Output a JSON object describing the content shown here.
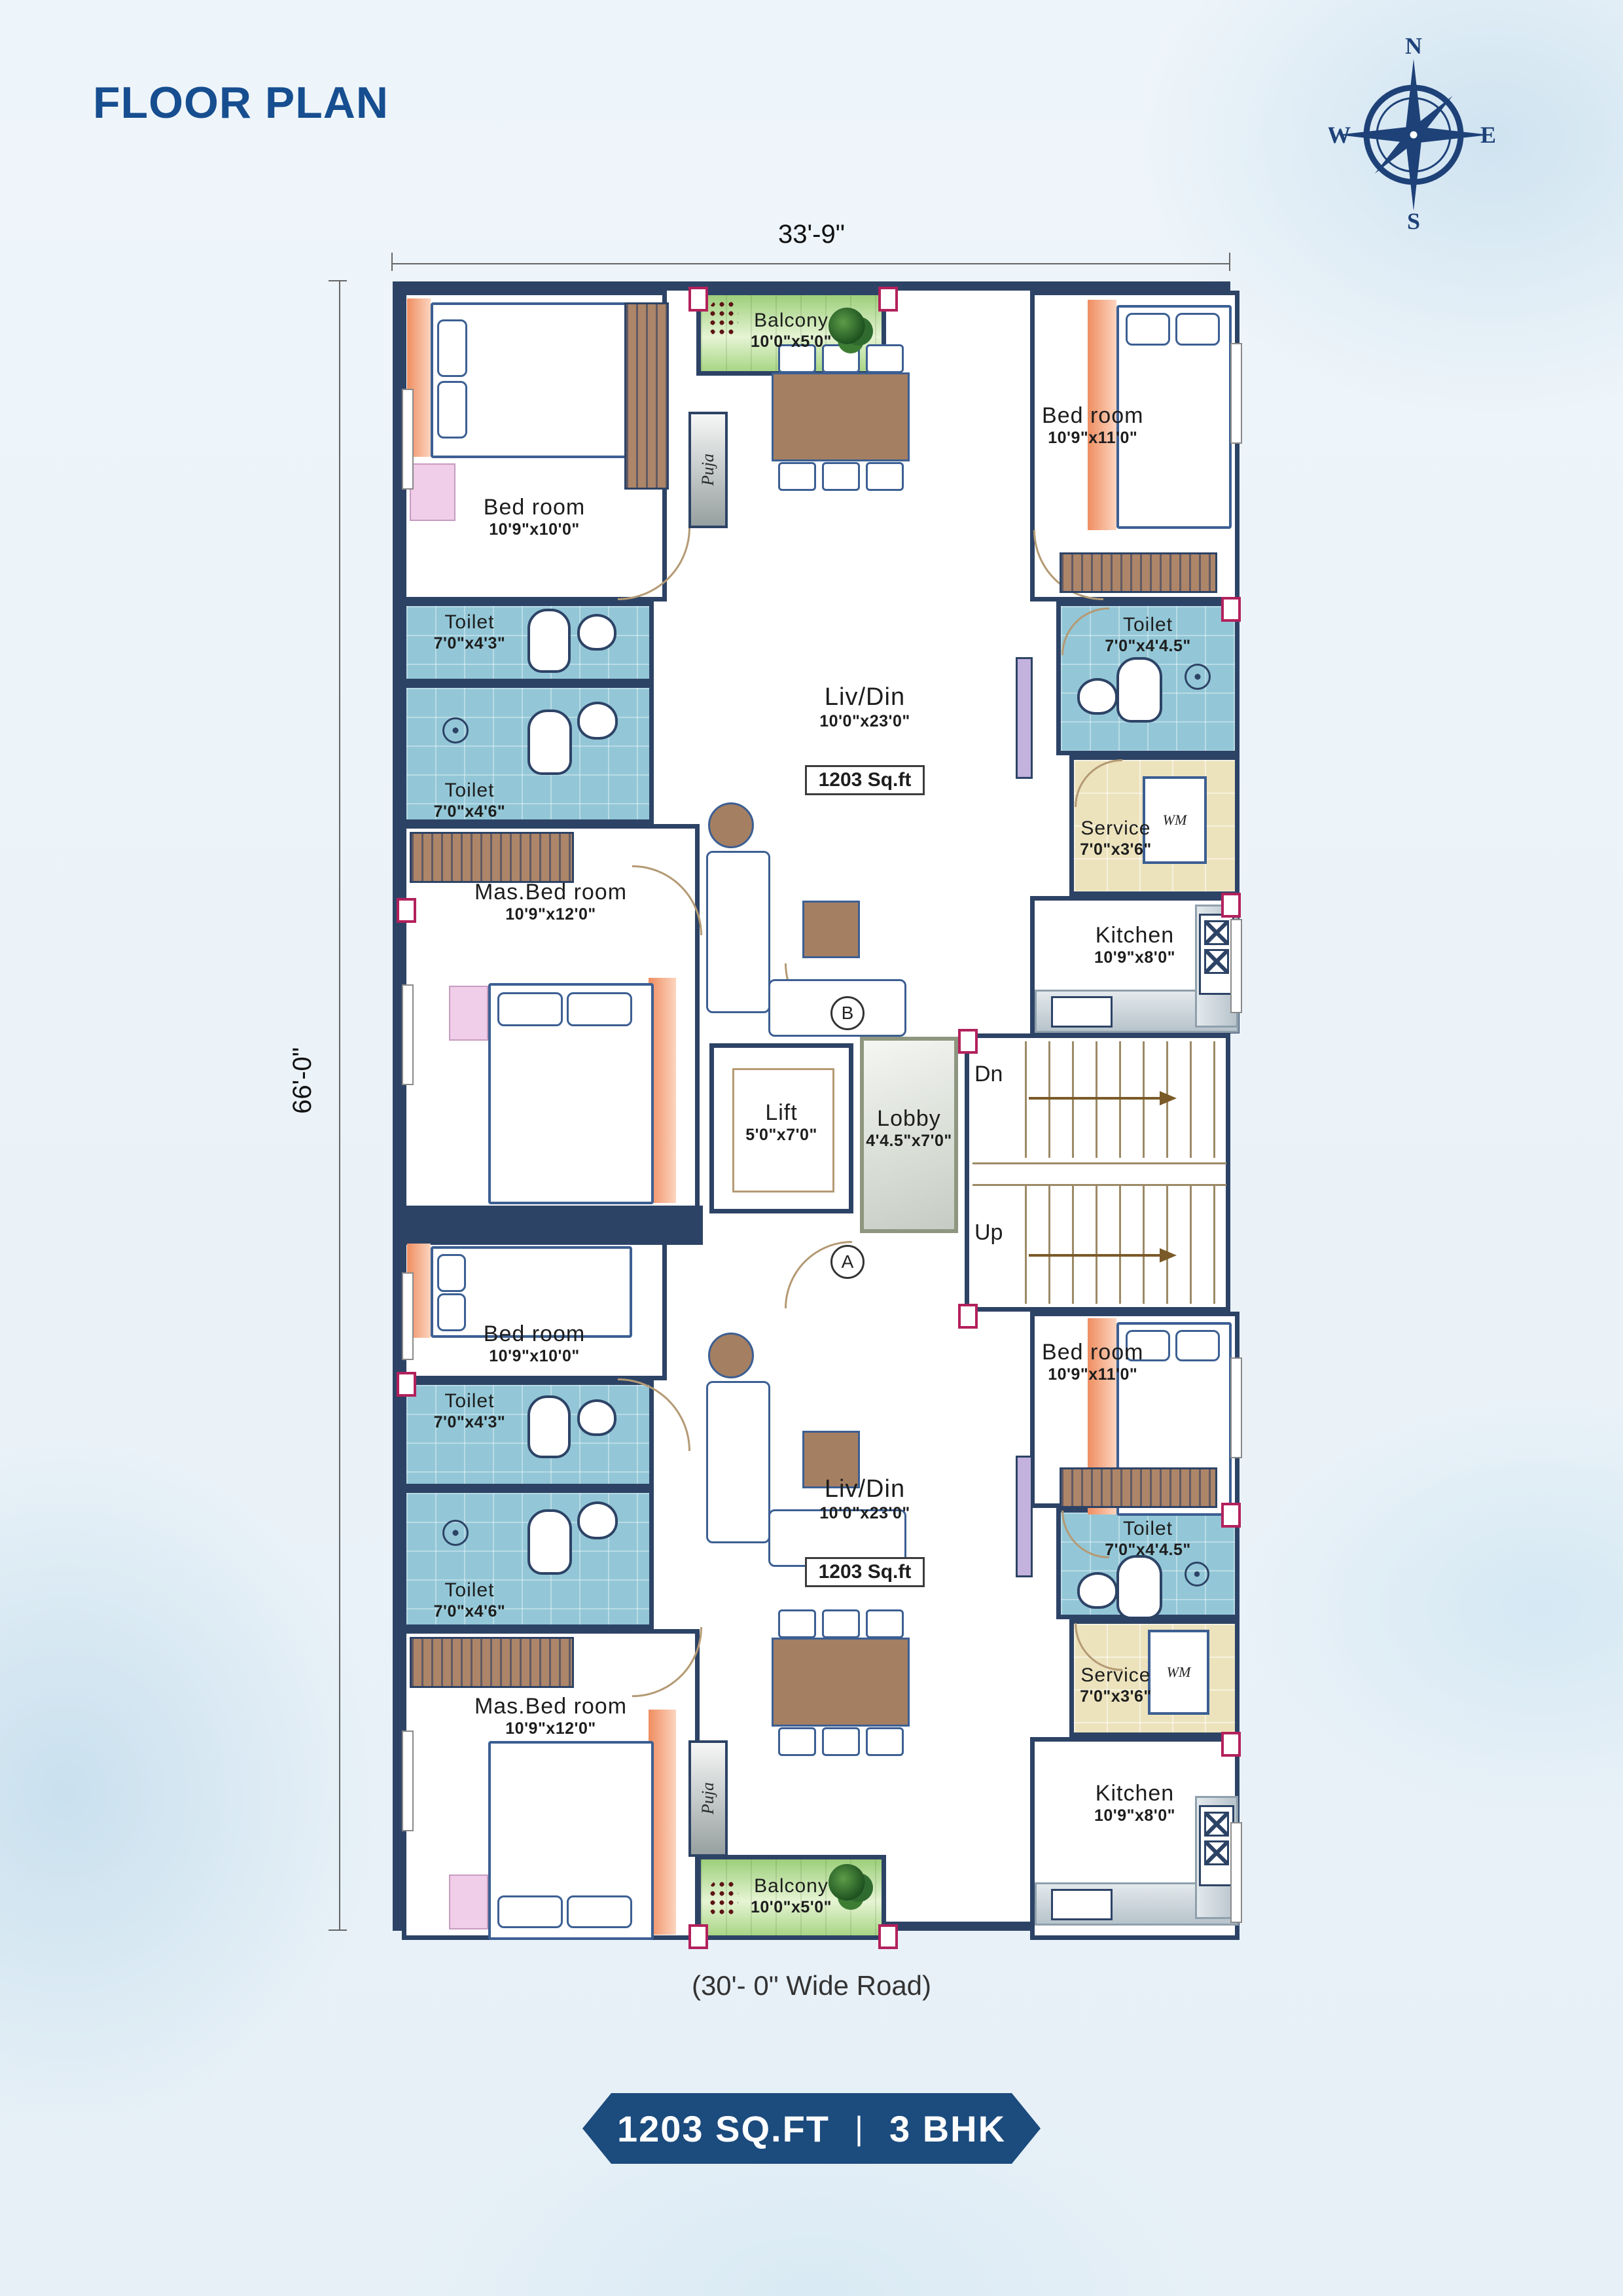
{
  "header": {
    "title": "FLOOR PLAN"
  },
  "compass": {
    "n": "N",
    "e": "E",
    "s": "S",
    "w": "W"
  },
  "dims": {
    "top": "33'-9\"",
    "left": "66'-0\"",
    "road": "(30'- 0\" Wide Road)"
  },
  "badge": {
    "area": "1203 SQ.FT",
    "sep": "|",
    "type": "3 BHK"
  },
  "core": {
    "lift": {
      "name": "Lift",
      "size": "5'0\"x7'0\""
    },
    "lobby": {
      "name": "Lobby",
      "size": "4'4.5\"x7'0\""
    },
    "stairs": {
      "down": "Dn",
      "up": "Up"
    },
    "markers": {
      "a": "A",
      "b": "B"
    }
  },
  "ut": {
    "balcony": {
      "name": "Balcony",
      "size": "10'0\"x5'0\""
    },
    "puja": "Puja",
    "bed_left": {
      "name": "Bed room",
      "size": "10'9\"x10'0\""
    },
    "bed_right": {
      "name": "Bed room",
      "size": "10'9\"x11'0\""
    },
    "toilet_a": {
      "name": "Toilet",
      "size": "7'0\"x4'3\""
    },
    "toilet_b": {
      "name": "Toilet",
      "size": "7'0\"x4'6\""
    },
    "toilet_right": {
      "name": "Toilet",
      "size": "7'0\"x4'4.5\""
    },
    "master": {
      "name": "Mas.Bed room",
      "size": "10'9\"x12'0\""
    },
    "living": {
      "name": "Liv/Din",
      "size": "10'0\"x23'0\"",
      "area": "1203 Sq.ft"
    },
    "service": {
      "name": "Service",
      "size": "7'0\"x3'6\"",
      "wm": "WM"
    },
    "kitchen": {
      "name": "Kitchen",
      "size": "10'9\"x8'0\""
    }
  },
  "ub": {
    "balcony": {
      "name": "Balcony",
      "size": "10'0\"x5'0\""
    },
    "puja": "Puja",
    "bed_left": {
      "name": "Bed room",
      "size": "10'9\"x10'0\""
    },
    "bed_right": {
      "name": "Bed room",
      "size": "10'9\"x11'0\""
    },
    "toilet_a": {
      "name": "Toilet",
      "size": "7'0\"x4'3\""
    },
    "toilet_b": {
      "name": "Toilet",
      "size": "7'0\"x4'6\""
    },
    "toilet_right": {
      "name": "Toilet",
      "size": "7'0\"x4'4.5\""
    },
    "master": {
      "name": "Mas.Bed room",
      "size": "10'9\"x12'0\""
    },
    "living": {
      "name": "Liv/Din",
      "size": "10'0\"x23'0\"",
      "area": "1203 Sq.ft"
    },
    "service": {
      "name": "Service",
      "size": "7'0\"x3'6\"",
      "wm": "WM"
    },
    "kitchen": {
      "name": "Kitchen",
      "size": "10'9\"x8'0\""
    }
  }
}
